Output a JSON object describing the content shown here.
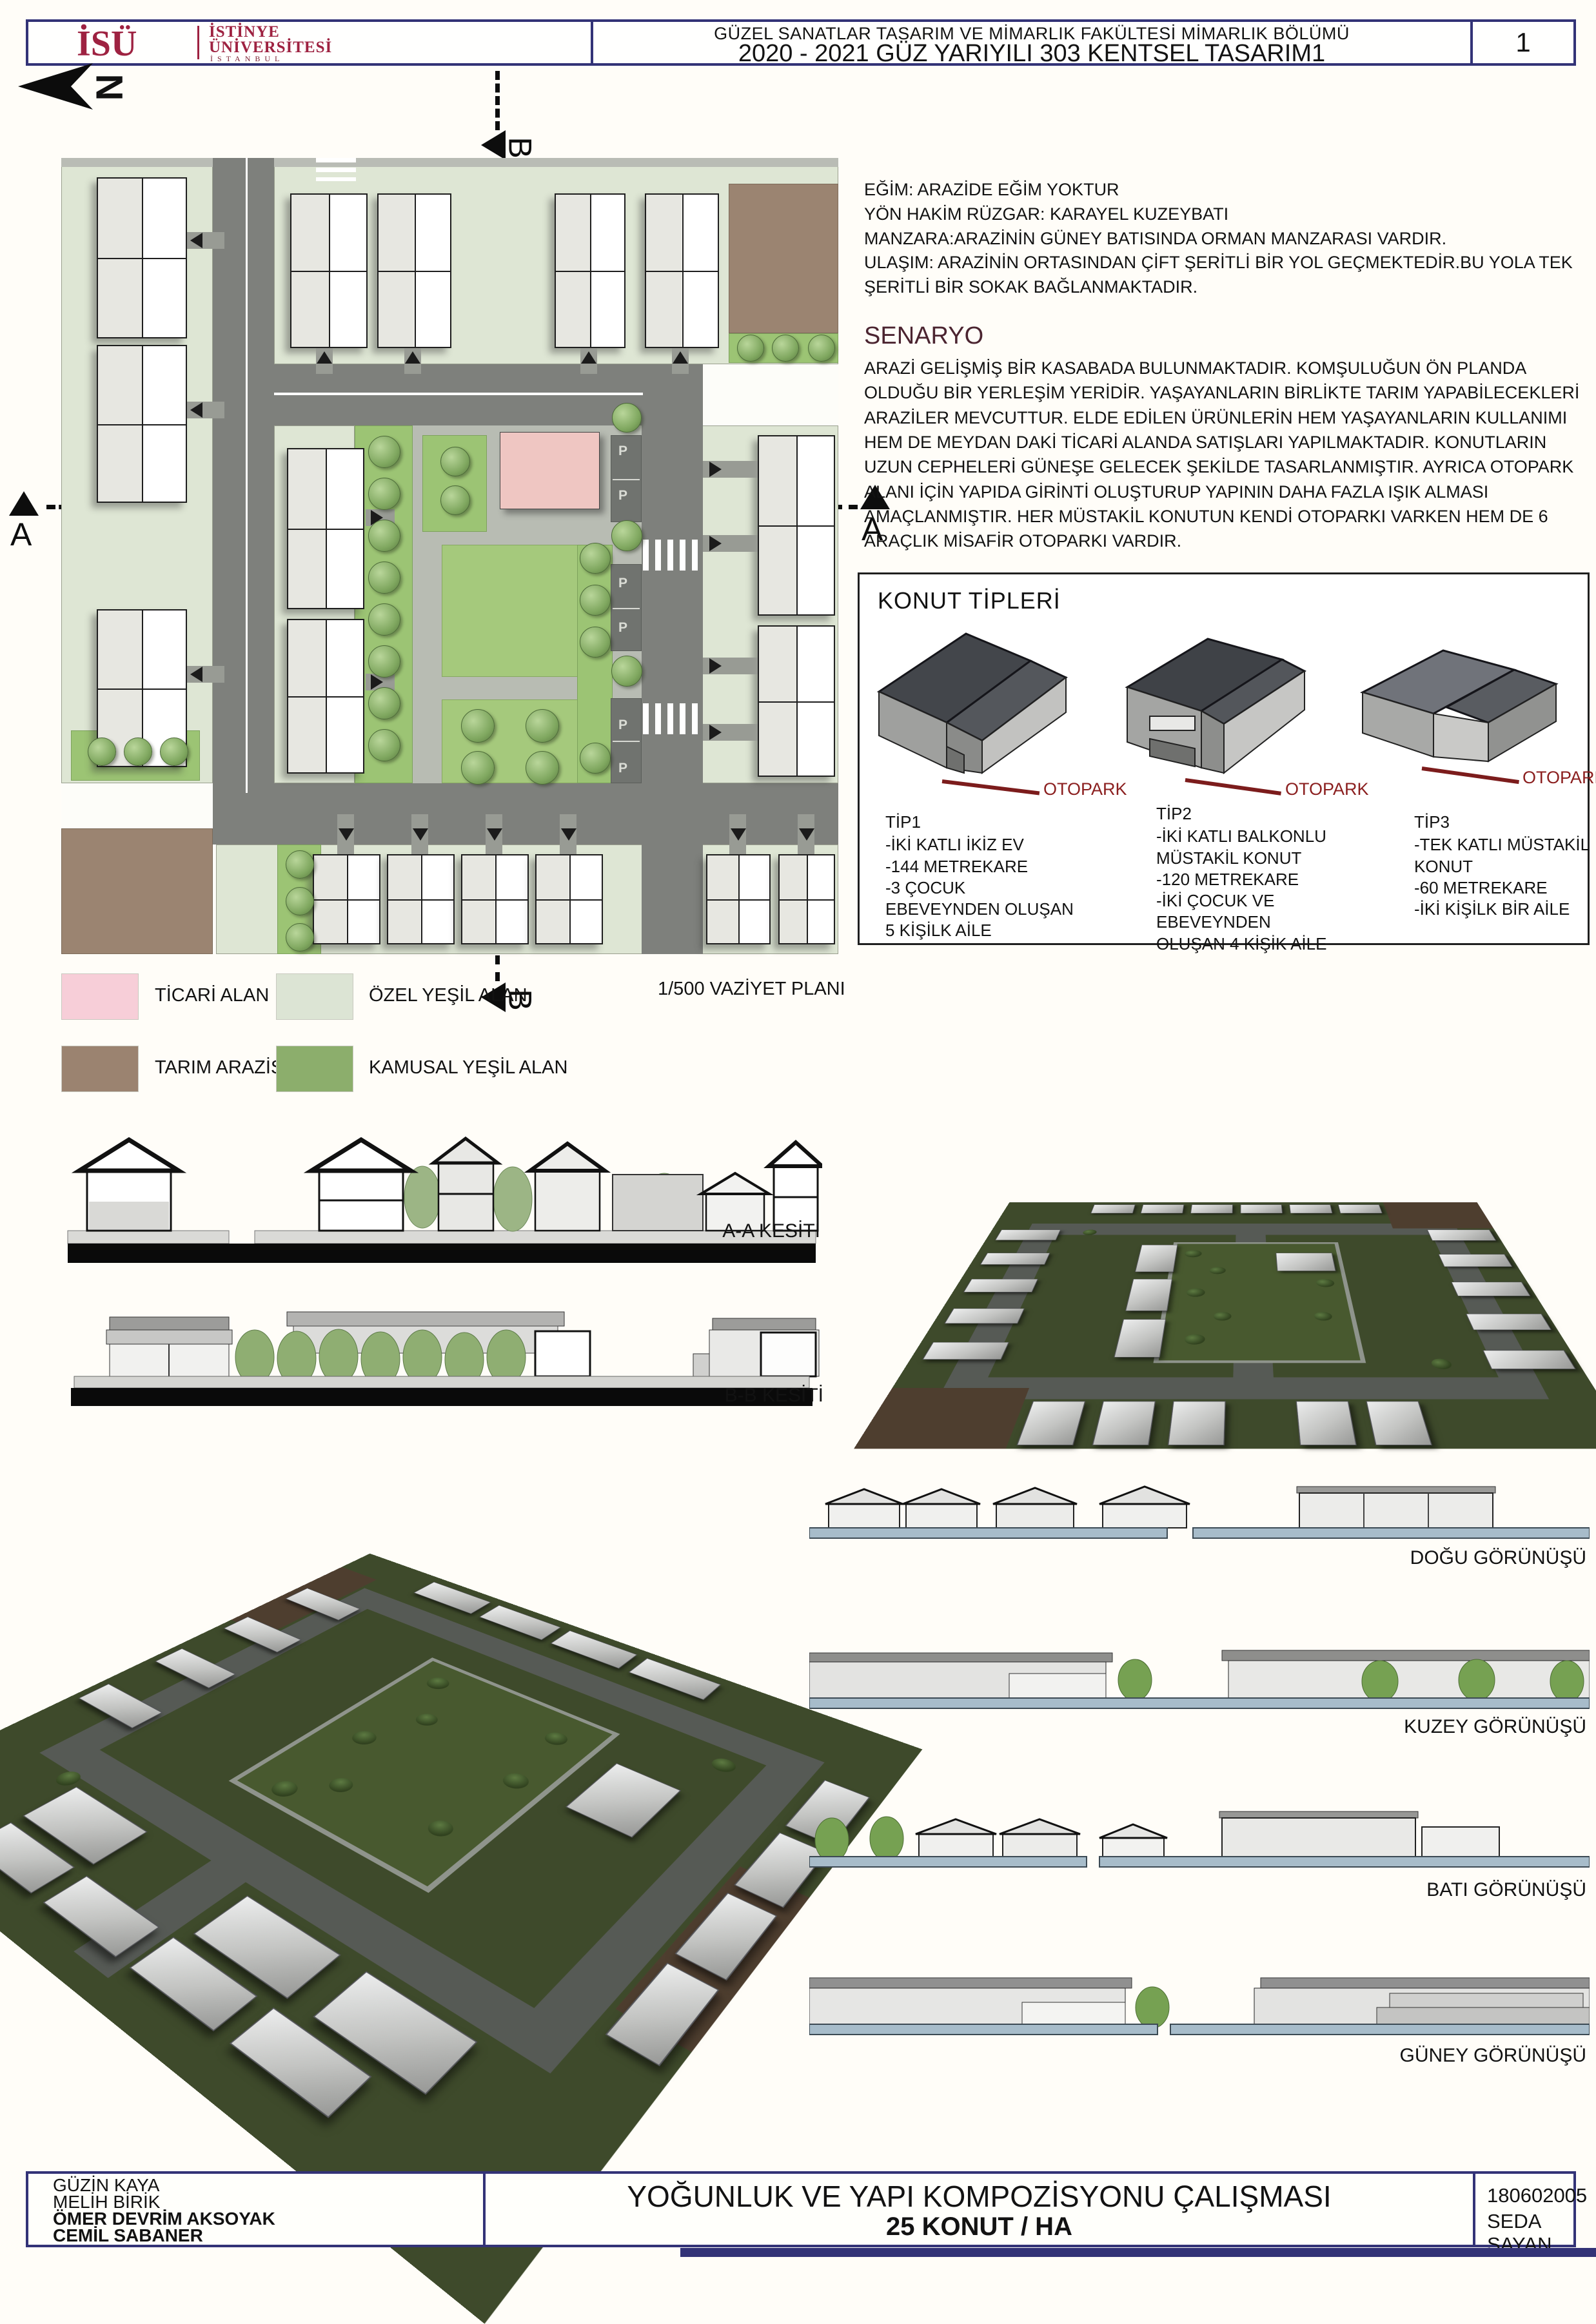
{
  "header": {
    "logo": {
      "acronym": "İSÜ",
      "name_line1": "İSTİNYE",
      "name_line2": "ÜNİVERSİTESİ",
      "city": "İSTANBUL"
    },
    "faculty_line": "GÜZEL SANATLAR TASARIM VE MİMARLIK FAKÜLTESİ MİMARLIK BÖLÜMÜ",
    "course_line": "2020 - 2021 GÜZ YARIYILI 303 KENTSEL TASARIM1",
    "page_number": "1"
  },
  "site_plan": {
    "north_letter": "N",
    "section_a": "A",
    "section_b": "B",
    "parking_label": "P",
    "scale_label": "1/500 VAZİYET PLANI"
  },
  "notes": {
    "lines": [
      "EĞİM: ARAZİDE EĞİM YOKTUR",
      "YÖN HAKİM RÜZGAR: KARAYEL KUZEYBATI",
      "MANZARA:ARAZİNİN GÜNEY BATISINDA ORMAN MANZARASI VARDIR.",
      "ULAŞIM: ARAZİNİN ORTASINDAN ÇİFT ŞERİTLİ BİR YOL GEÇMEKTEDİR.BU YOLA TEK",
      "ŞERİTLİ BİR SOKAK BAĞLANMAKTADIR."
    ],
    "senaryo_title": "SENARYO",
    "senaryo_text": " ARAZİ GELİŞMİŞ BİR KASABADA BULUNMAKTADIR. KOMŞULUĞUN ÖN PLANDA OLDUĞU BİR YERLEŞİM YERİDİR. YAŞAYANLARIN BİRLİKTE TARIM YAPABİLECEKLERİ ARAZİLER MEVCUTTUR. ELDE EDİLEN ÜRÜNLERİN HEM YAŞAYANLARIN KULLANIMI HEM DE MEYDAN DAKİ TİCARİ ALANDA SATIŞLARI YAPILMAKTADIR. KONUTLARIN UZUN CEPHELERİ GÜNEŞE GELECEK ŞEKİLDE TASARLANMIŞTIR. AYRICA OTOPARK ALANI İÇİN YAPIDA GİRİNTİ OLUŞTURUP YAPININ DAHA FAZLA IŞIK ALMASI AMAÇLANMIŞTIR. HER MÜSTAKİL KONUTUN KENDİ OTOPARKI VARKEN HEM DE 6 ARAÇLIK MİSAFİR OTOPARKI VARDIR."
  },
  "housing_types": {
    "title": "KONUT TİPLERİ",
    "otopark_label": "OTOPARK",
    "types": [
      {
        "name": "TİP1",
        "lines": [
          "-İKİ KATLI İKİZ EV",
          "-144 METREKARE",
          "-3 ÇOCUK",
          "EBEVEYNDEN OLUŞAN",
          "5 KİŞİLK AİLE"
        ]
      },
      {
        "name": "TİP2",
        "lines": [
          "-İKİ KATLI BALKONLU",
          "MÜSTAKİL KONUT",
          "-120 METREKARE",
          "-İKİ ÇOCUK VE",
          "EBEVEYNDEN",
          "OLUŞAN 4 KİŞİK AİLE"
        ]
      },
      {
        "name": "TİP3",
        "lines": [
          "-TEK KATLI MÜSTAKİL",
          "KONUT",
          "-60 METREKARE",
          "-İKİ KİŞİLK BİR AİLE"
        ]
      }
    ]
  },
  "legend": {
    "items": [
      {
        "label": "TİCARİ ALAN",
        "color": "#f7ced8"
      },
      {
        "label": "ÖZEL YEŞİL  ALAN",
        "color": "#dce4d4"
      },
      {
        "label": "TARIM ARAZİSİ",
        "color": "#9b8370"
      },
      {
        "label": "KAMUSAL YEŞİL ALAN",
        "color": "#8cae6c"
      }
    ]
  },
  "sections": {
    "labels": [
      "A-A KESİTİ",
      "B-B KESİTİ"
    ]
  },
  "elevations": {
    "labels": [
      "DOĞU GÖRÜNÜŞÜ",
      "KUZEY GÖRÜNÜŞÜ",
      "BATI GÖRÜNÜŞÜ",
      "GÜNEY GÖRÜNÜŞÜ"
    ]
  },
  "footer": {
    "authors": [
      "GÜZİN KAYA",
      "MELİH BİRİK",
      "ÖMER DEVRİM AKSOYAK",
      "CEMİL SABANER"
    ],
    "title_line1": "YOĞUNLUK VE YAPI KOMPOZİSYONU ÇALIŞMASI",
    "title_line2": "25 KONUT / HA",
    "student_id": "180602005",
    "student_name": "SEDA SAYAN"
  },
  "colors": {
    "frame_navy": "#333377",
    "logo_maroon": "#9e2241",
    "otopark_red": "#7c1c1c",
    "road_gray": "#7e807c",
    "park_green": "#a5c97c",
    "elevation_base_blue": "#a7bcca"
  }
}
